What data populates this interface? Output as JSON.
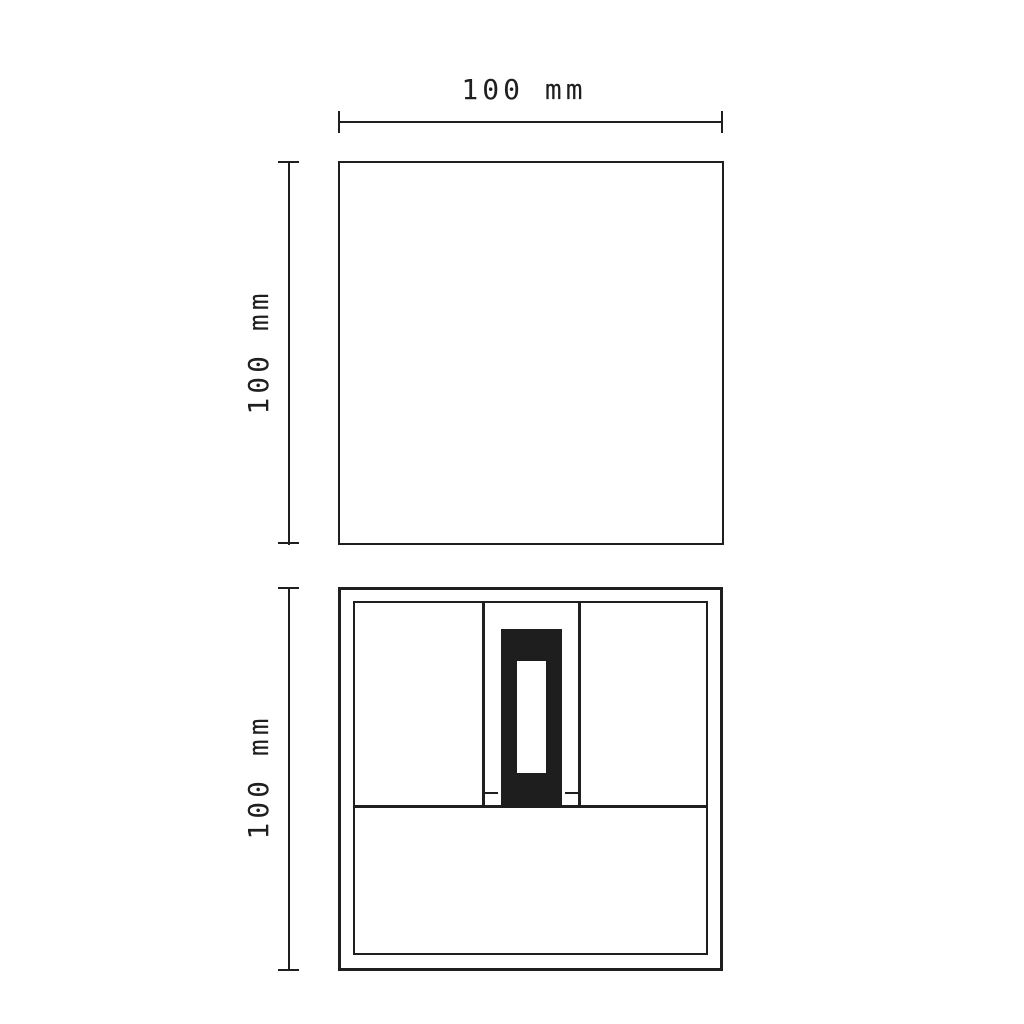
{
  "drawing": {
    "background": "#ffffff",
    "ink_color": "#1f1f1f",
    "module_fill": "#1e1e1e",
    "top_view": {
      "width_dimension": "100 mm",
      "height_dimension": "100 mm"
    },
    "front_view": {
      "height_dimension": "100 mm"
    }
  }
}
